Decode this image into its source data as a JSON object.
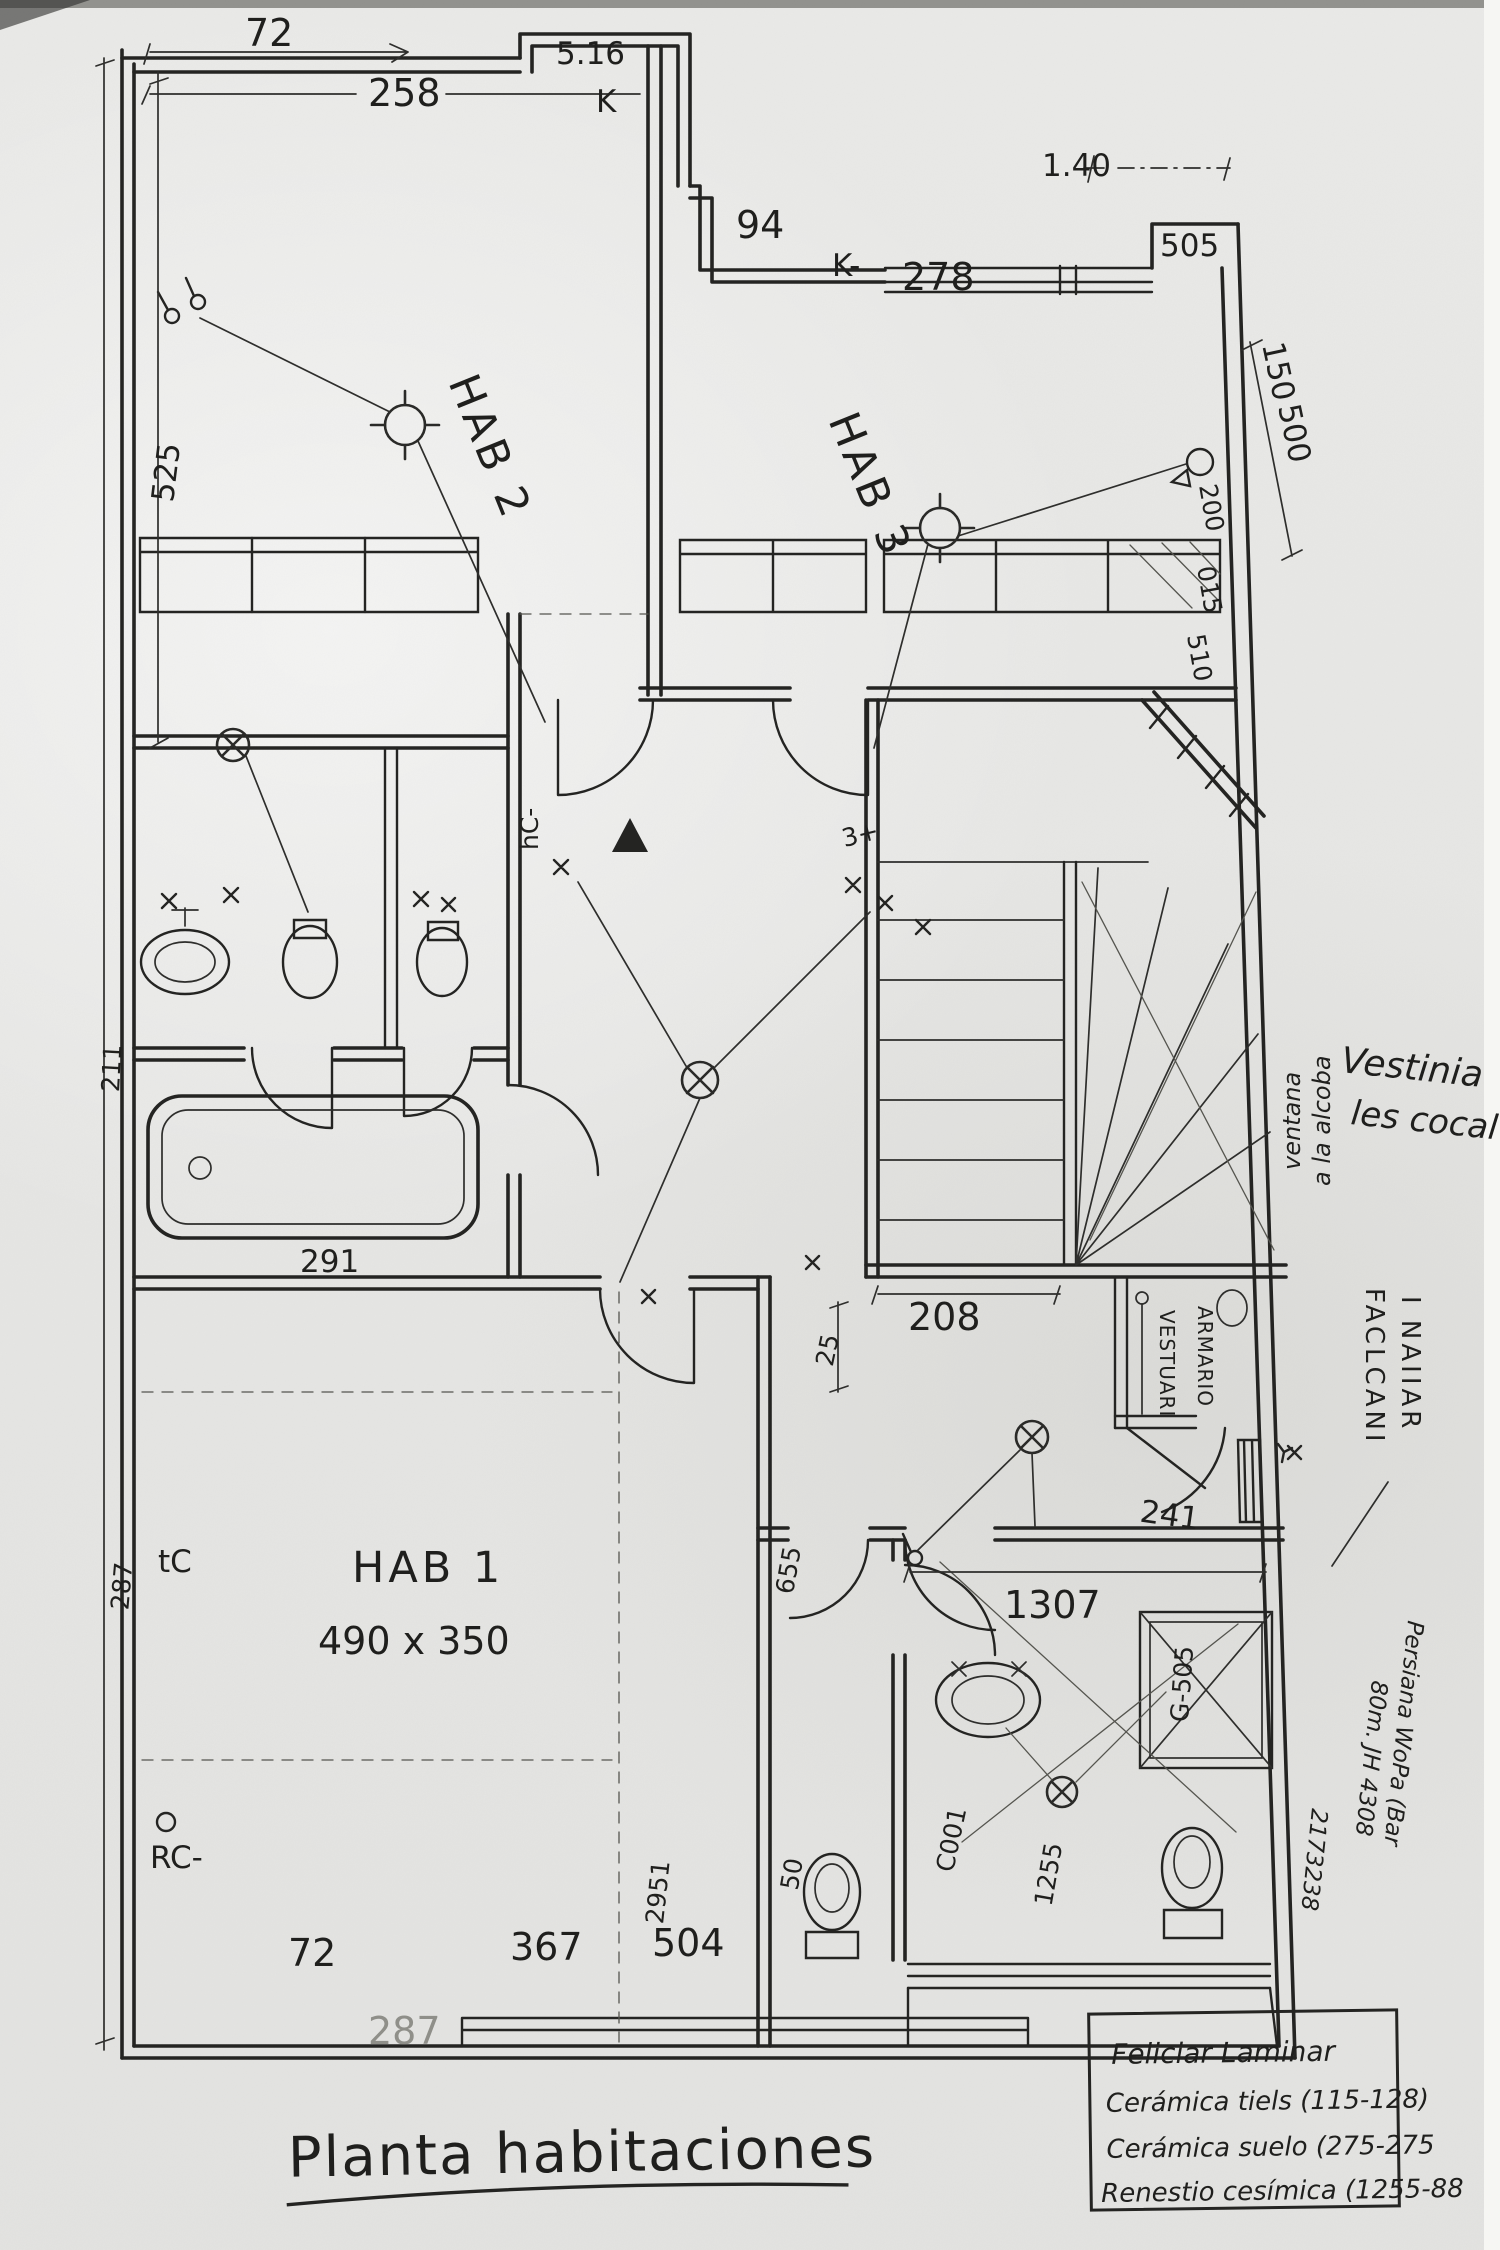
{
  "title": "Planta habitaciones",
  "rooms": {
    "hab1": "HAB 1",
    "hab1_size": "490 x 350",
    "hab2": "HAB 2",
    "hab3": "HAB 3"
  },
  "dims_top": {
    "t72": "72",
    "t258": "258",
    "t516": "5.16",
    "tK": "K",
    "t94": "94",
    "tKdash": "K-",
    "t278": "278",
    "t140": "1.40",
    "t505": "505"
  },
  "dims_right": {
    "r150": "150",
    "r500": "500",
    "r200": "200",
    "r015": "015",
    "r510": "510"
  },
  "dims_left": {
    "l525": "525",
    "l211": "211",
    "l287": "287"
  },
  "dims_inner": {
    "tub": "291",
    "stairs": "208",
    "hall": "25",
    "bath": "1307",
    "vest": "241",
    "v655": "655",
    "v1255": "1255",
    "v5505": "G-505",
    "vc001": "C001",
    "v2951": "2951",
    "v50": "50"
  },
  "dims_bottom": {
    "b72": "72",
    "b367": "367",
    "b504": "504",
    "b287": "287"
  },
  "labels": {
    "tc": "tC",
    "rc": "RC-",
    "hc": "hC-",
    "s3": "3+",
    "vestuari": "VESTUARI",
    "armario": "ARMARIO"
  },
  "notes": {
    "win_v1": "ventana",
    "win_v2": "a la alcoba",
    "cur1": "Vestinia",
    "cur2": "les cocal",
    "side1": "FACLCANI",
    "side2": "I NAIIAR",
    "per1": "Persiana WoPa (Bar",
    "per2": "80m. JH 4308",
    "per3": "2173238"
  },
  "legend": {
    "l1": "Feliciar Laminar",
    "l2": "Cerámica tiels (115-128)",
    "l3": "Cerámica suelo (275-275",
    "l4": "Renestio cesímica (1255-88"
  }
}
